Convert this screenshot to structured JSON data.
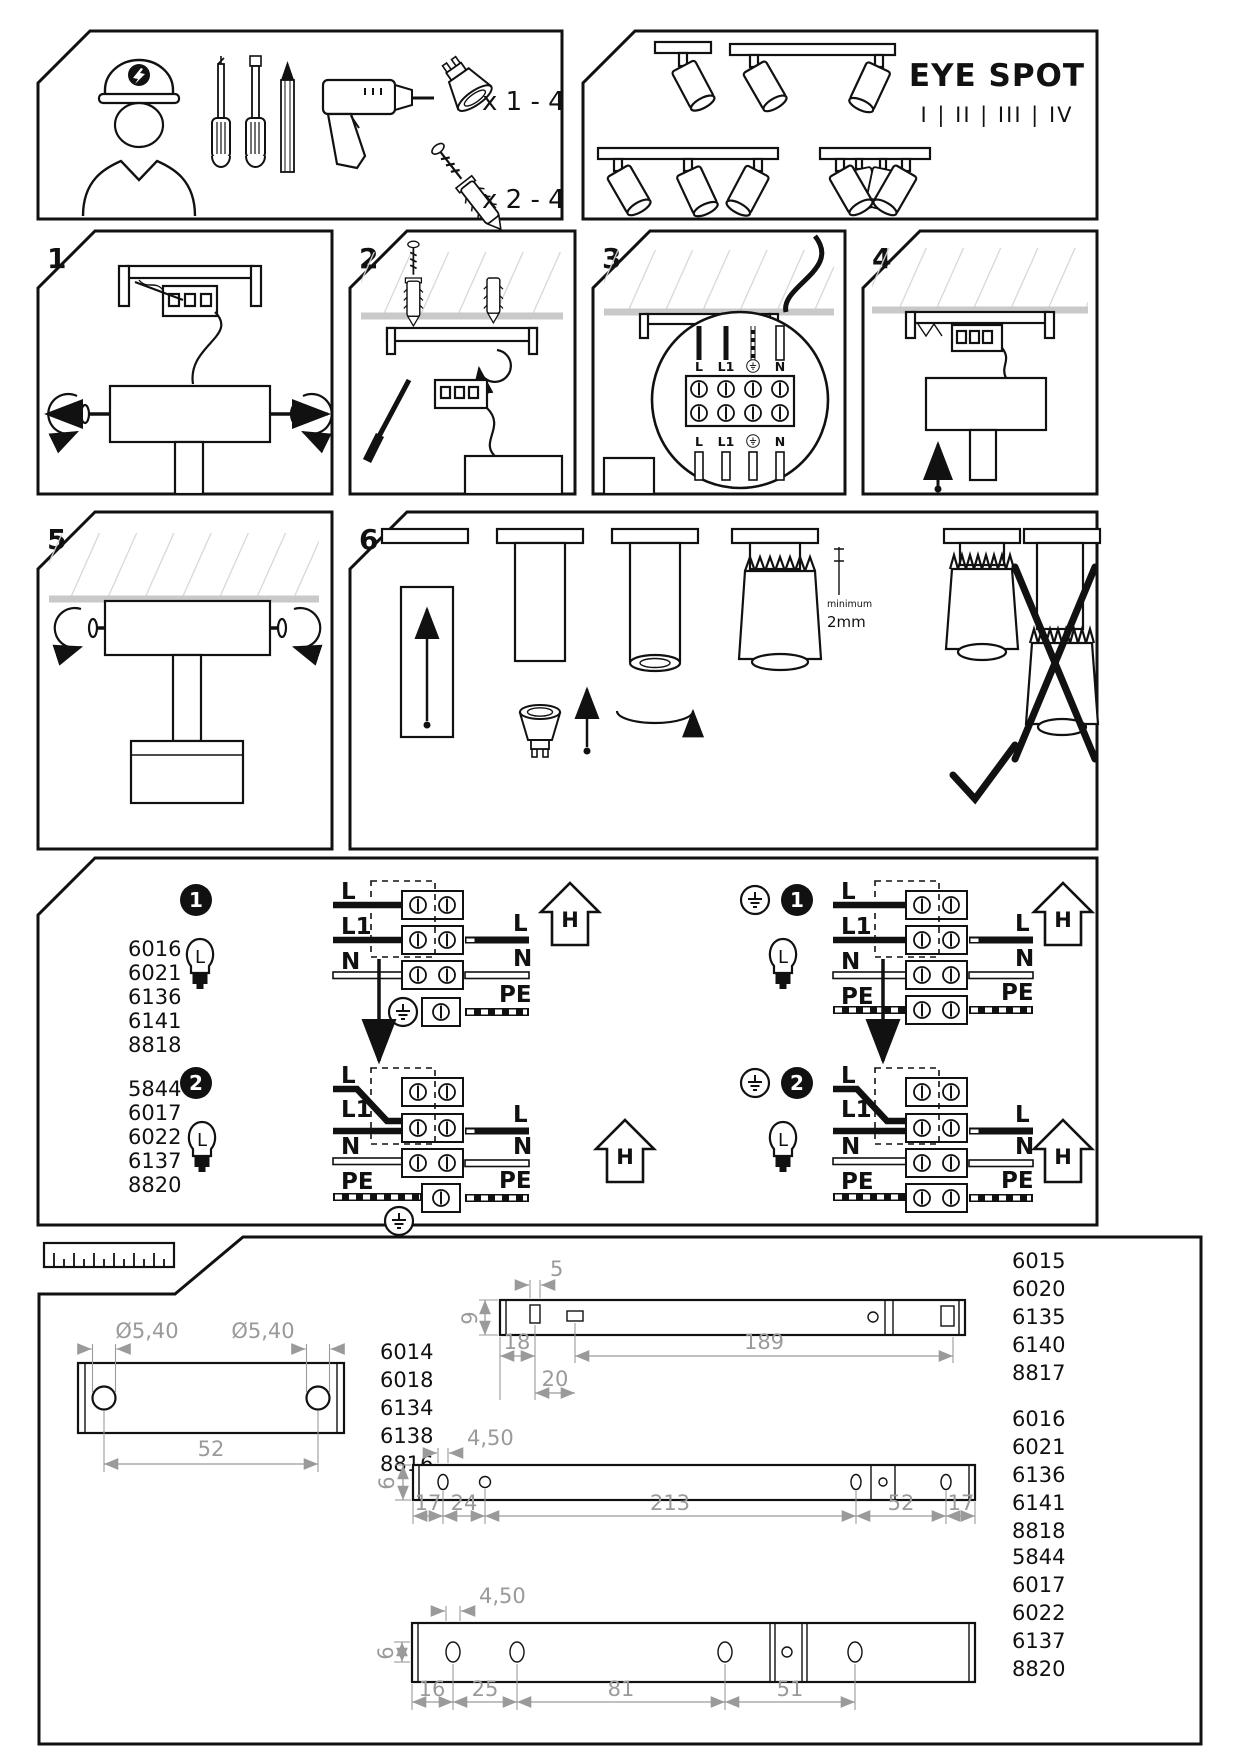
{
  "header": {
    "title": "EYE SPOT",
    "variants": "I | II | III | IV"
  },
  "tools": {
    "bulb_qty": "x 1 - 4",
    "anchor_qty": "x 2 - 4"
  },
  "steps": {
    "n1": "1",
    "n2": "2",
    "n3": "3",
    "n4": "4",
    "n5": "5",
    "n6": "6"
  },
  "step3_labels": {
    "l": "L",
    "l1": "L1",
    "n": "N"
  },
  "step6": {
    "minimum_label": "minimum",
    "min_gap": "2mm"
  },
  "wiring": {
    "group1_badge": "1",
    "group2_badge": "2",
    "lamp_letter": "L",
    "house_letter": "H",
    "label_l": "L",
    "label_l1": "L1",
    "label_n": "N",
    "label_pe": "PE",
    "group1_models": [
      "6016",
      "6021",
      "6136",
      "6141",
      "8818"
    ],
    "group2_models": [
      "5844",
      "6017",
      "6022",
      "6137",
      "8820"
    ]
  },
  "dimensions": {
    "bracket": {
      "hole_d1": "Ø5,40",
      "hole_d2": "Ø5,40",
      "spacing": "52",
      "models": [
        "6014",
        "6018",
        "6134",
        "6138",
        "8816"
      ]
    },
    "bar1": {
      "slot": "5",
      "height": "9",
      "a": "18",
      "b": "20",
      "c": "189",
      "models": [
        "6015",
        "6020",
        "6135",
        "6140",
        "8817"
      ]
    },
    "bar2": {
      "hole": "4,50",
      "height": "6",
      "a": "17",
      "b": "24",
      "c": "213",
      "d": "52",
      "e": "17",
      "models": [
        "6016",
        "6021",
        "6136",
        "6141",
        "8818"
      ]
    },
    "bar3": {
      "hole": "4,50",
      "height": "6",
      "a": "16",
      "b": "25",
      "c": "81",
      "d": "51",
      "models": [
        "5844",
        "6017",
        "6022",
        "6137",
        "8820"
      ]
    }
  },
  "colors": {
    "line": "#111111",
    "dim_gray": "#9a9a9a",
    "ceiling_gray": "#c9c9c9"
  }
}
